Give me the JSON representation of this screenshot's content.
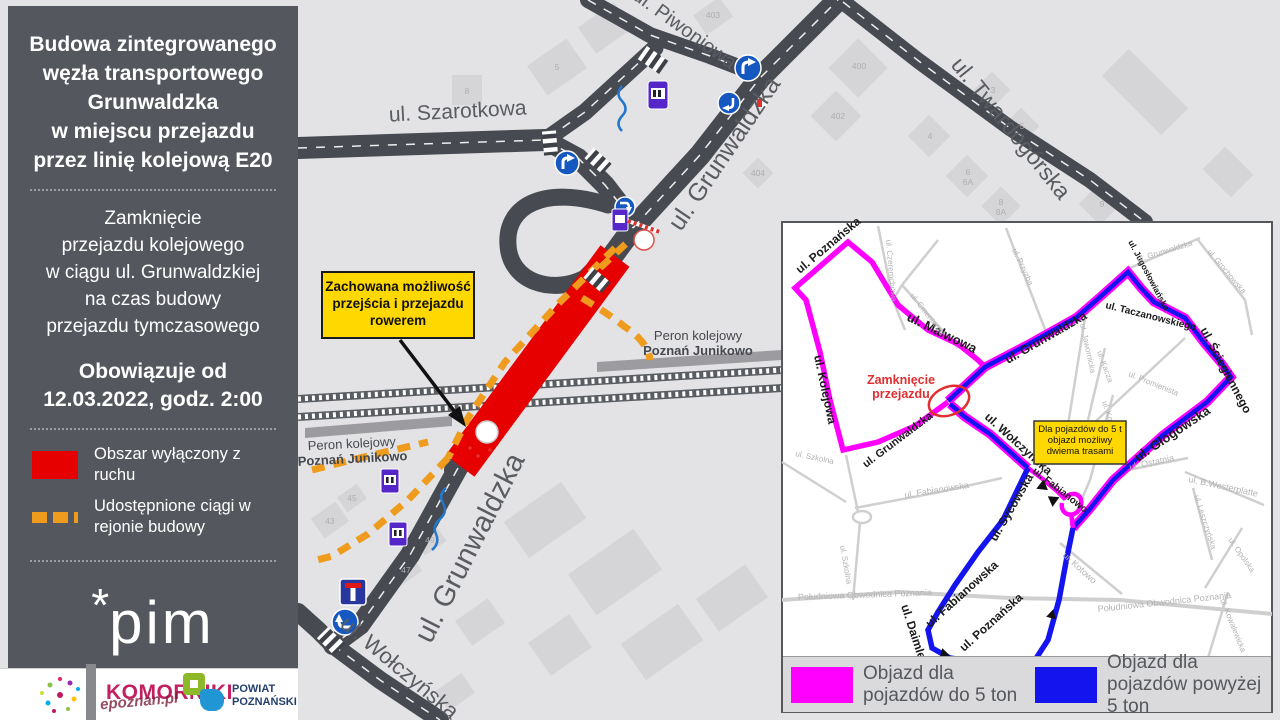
{
  "colors": {
    "sidebar_bg": "#54575e",
    "closed_area_red": "#e60000",
    "construction_orange": "#ef9b1d",
    "detour_under5t_magenta": "#ff00ff",
    "detour_over5t_blue": "#1414ee",
    "note_yellow": "#ffd800",
    "road_dark": "#474a50",
    "map_bg": "#e3e3e5"
  },
  "sidebar": {
    "title_lines": [
      "Budowa zintegrowanego",
      "węzła transportowego",
      "Grunwaldzka",
      "w miejscu przejazdu",
      "przez linię kolejową E20"
    ],
    "closure_lines": [
      "Zamknięcie",
      "przejazdu kolejowego",
      "w ciągu ul. Grunwaldzkiej",
      "na czas budowy",
      "przejazdu tymczasowego"
    ],
    "effective_lines": [
      "Obowiązuje od",
      "12.03.2022, godz. 2:00"
    ],
    "legend": [
      {
        "label": "Obszar wyłączony z ruchu",
        "swatch": "red-solid"
      },
      {
        "label": "Udostępnione ciągi w rejonie budowy",
        "swatch": "orange-dashed"
      }
    ],
    "logo_star": "*",
    "logo_text": "pim"
  },
  "footer": {
    "komorniki": "KOMORNIKI",
    "watermark": "epoznan.pl",
    "powiat_line1": "POWIAT",
    "powiat_line2": "POZNAŃSKI"
  },
  "map": {
    "callout_lines": [
      "Zachowana możliwość",
      "przejścia i przejazdu",
      "rowerem"
    ],
    "labels": [
      {
        "t": "ul. Szarotkowa"
      },
      {
        "t": "ul. Piwoniowa"
      },
      {
        "t": "ul. Grunwaldzka"
      },
      {
        "t": "ul. Twardogórska"
      },
      {
        "t": "ul. Grunwaldzka"
      },
      {
        "t": "ul. Wołczyńska"
      },
      {
        "t": "Peron kolejowy"
      },
      {
        "t": "Poznań Junikowo"
      },
      {
        "t": "Peron kolejowy"
      },
      {
        "t": "Poznań Junikowo"
      }
    ],
    "numbers": [
      {
        "t": "403"
      },
      {
        "t": "400"
      },
      {
        "t": "402"
      },
      {
        "t": "3"
      },
      {
        "t": "4"
      },
      {
        "t": "5"
      },
      {
        "t": "6"
      },
      {
        "t": "6A"
      },
      {
        "t": "8"
      },
      {
        "t": "8A"
      },
      {
        "t": "9"
      },
      {
        "t": "404"
      },
      {
        "t": "8"
      },
      {
        "t": "5"
      },
      {
        "t": "43"
      },
      {
        "t": "45"
      },
      {
        "t": "47"
      },
      {
        "t": "49"
      }
    ]
  },
  "inset": {
    "closure_lines": [
      "Zamknięcie",
      "przejazdu"
    ],
    "note_lines": [
      "Dla pojazdów do 5 t",
      "objazd możliwy",
      "dwiema trasami"
    ],
    "legend": [
      {
        "label": "Objazd dla pojazdów do 5 ton",
        "color": "#ff00ff"
      },
      {
        "label": "Objazd dla pojazdów powyżej 5 ton",
        "color": "#1414ee"
      }
    ],
    "route_labels": [
      {
        "t": "ul. Poznańska"
      },
      {
        "t": "ul. Kolejowa"
      },
      {
        "t": "ul. Malwowa"
      },
      {
        "t": "ul. Grunwaldzka"
      },
      {
        "t": "ul. Grunwaldzka"
      },
      {
        "t": "ul. Wołczyńska"
      },
      {
        "t": "ul. Jugosłowiańska"
      },
      {
        "t": "ul. Taczanowskiego"
      },
      {
        "t": "ul. Ściegiennego"
      },
      {
        "t": "ul. Głogowska"
      },
      {
        "t": "ul. Sycowska"
      },
      {
        "t": "ul. Fabianowska"
      },
      {
        "t": "ul. Daimlera"
      },
      {
        "t": "ul. Poznańska"
      },
      {
        "t": "ul. Fabianowo"
      }
    ],
    "minor_labels": [
      {
        "t": "ul. Czeremchowa"
      },
      {
        "t": "ul. Cmentarna"
      },
      {
        "t": "ul. Przyzba"
      },
      {
        "t": "ul. Grunwaldzka"
      },
      {
        "t": "ul. Grochowska"
      },
      {
        "t": "ul. Jawornicka"
      },
      {
        "t": "ul. Promienista"
      },
      {
        "t": "ul. Kacza"
      },
      {
        "t": "ul. Kopanina"
      },
      {
        "t": "ul. Fabianowska"
      },
      {
        "t": "ul. Szkolna"
      },
      {
        "t": "ul. Szkolna"
      },
      {
        "t": "ul. Ostatnia"
      },
      {
        "t": "ul. B.Westerplatte"
      },
      {
        "t": "ul. Leszczyńska"
      },
      {
        "t": "ul. Opolska"
      },
      {
        "t": "ul. Kotowo"
      },
      {
        "t": "Południowa Obwodnica Poznania"
      },
      {
        "t": "Południowa Obwodnica Poznania"
      },
      {
        "t": "ul. Kowalewicka"
      }
    ]
  }
}
